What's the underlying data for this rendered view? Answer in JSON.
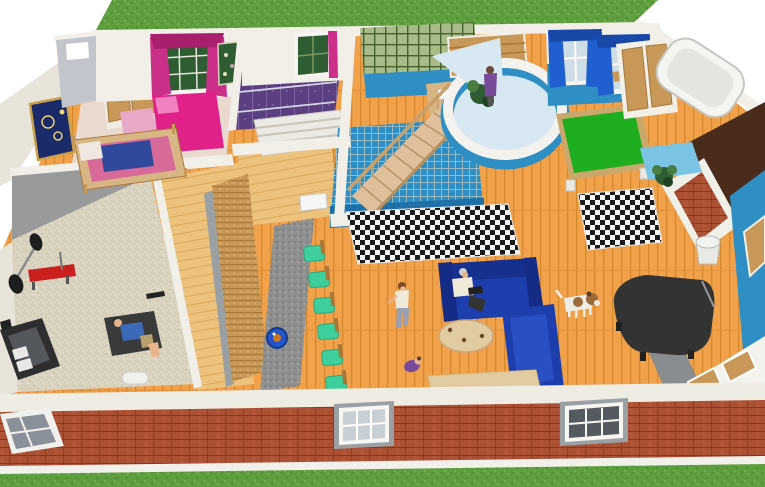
{
  "scene": {
    "view": "3d-dollhouse-cutaway-render",
    "environment": [
      "grass lawn strip behind house",
      "grass lawn strip in front",
      "white backdrop"
    ],
    "exterior": [
      "red brick front wall",
      "white trim bands",
      "white sash windows",
      "skewed corner window"
    ],
    "rooms": [
      {
        "name": "bedroom",
        "items": [
          "magenta double bed",
          "tan canopy bed",
          "pink rug",
          "window with magenta curtains",
          "starry framed painting",
          "double closet doors",
          "green floral wall art",
          "gray entry nook"
        ]
      },
      {
        "name": "purple-room",
        "items": [
          "purple patterned floor with white grid",
          "white slatted bed",
          "window with plant",
          "magenta curtain sliver"
        ]
      },
      {
        "name": "stair-hall",
        "items": [
          "wooden staircase",
          "wood railing with balusters",
          "green trellis wall",
          "wood-blind window",
          "tan desk",
          "blue mesh wall under stairs"
        ]
      },
      {
        "name": "round-lounge",
        "items": [
          "curved white wall with blue base",
          "standing person in purple top",
          "potted plant",
          "pale blue floor"
        ]
      },
      {
        "name": "games-room",
        "items": [
          "green pool table",
          "two windows with blue curtains",
          "model ship on sill",
          "blue wainscot wall"
        ]
      },
      {
        "name": "right-wing",
        "items": [
          "wooden closet double doors",
          "white bathtub",
          "brick fireplace with white mantel",
          "dark chimney wall",
          "white planter bucket",
          "potted palm",
          "blue wall with tan window",
          "white door band with tan panels",
          "gray wedge wall"
        ]
      },
      {
        "name": "gym",
        "items": [
          "speckled beige carpet",
          "black treadmill",
          "red weight bench",
          "barbell with black plates",
          "black dumbbell",
          "dark exercise mat",
          "person lying on mat",
          "white floor mat",
          "gray walls"
        ]
      },
      {
        "name": "kitchen-bar",
        "items": [
          "gray granite counter",
          "round blue sink with orange tap",
          "six teal bar chairs",
          "wicker cabinet row",
          "light plank floor",
          "white appliance top"
        ]
      },
      {
        "name": "living-area",
        "items": [
          "two black-white checkered rugs",
          "two royal blue sofas",
          "seated man reading",
          "standing woman",
          "crawling toddler in purple",
          "beagle dog",
          "oval beige table",
          "black grand piano",
          "beige doormat"
        ]
      }
    ]
  },
  "colors": {
    "grass": "#5f9e3e",
    "wood": "#f0a149",
    "brick": "#aa5034",
    "wall": "#f2efe8",
    "gym_carpet": "#d9d3c0",
    "counter_gray": "#8f8f8f",
    "chair_teal": "#3ecf9c",
    "sofa_blue": "#1d3fae",
    "accent_blue": "#2f8fc4",
    "curtain_blue": "#1f5fd0",
    "magenta": "#cc2f8a",
    "bed_pink": "#e0218a",
    "purple_floor": "#5a4080",
    "lattice_green": "#a8bc8a",
    "pool_green": "#1fae1f",
    "tan_wood": "#c89858",
    "stair_wood": "#dfc09a",
    "piano_black": "#333333",
    "bench_red": "#cc1f1f",
    "chimney_brown": "#4a2c1c",
    "sink_blue": "#2255cc",
    "table_beige": "#e2cba0",
    "dog_brown": "#9a6a3a",
    "skin": "#e8b48c",
    "plant_green": "#2e5d33"
  }
}
